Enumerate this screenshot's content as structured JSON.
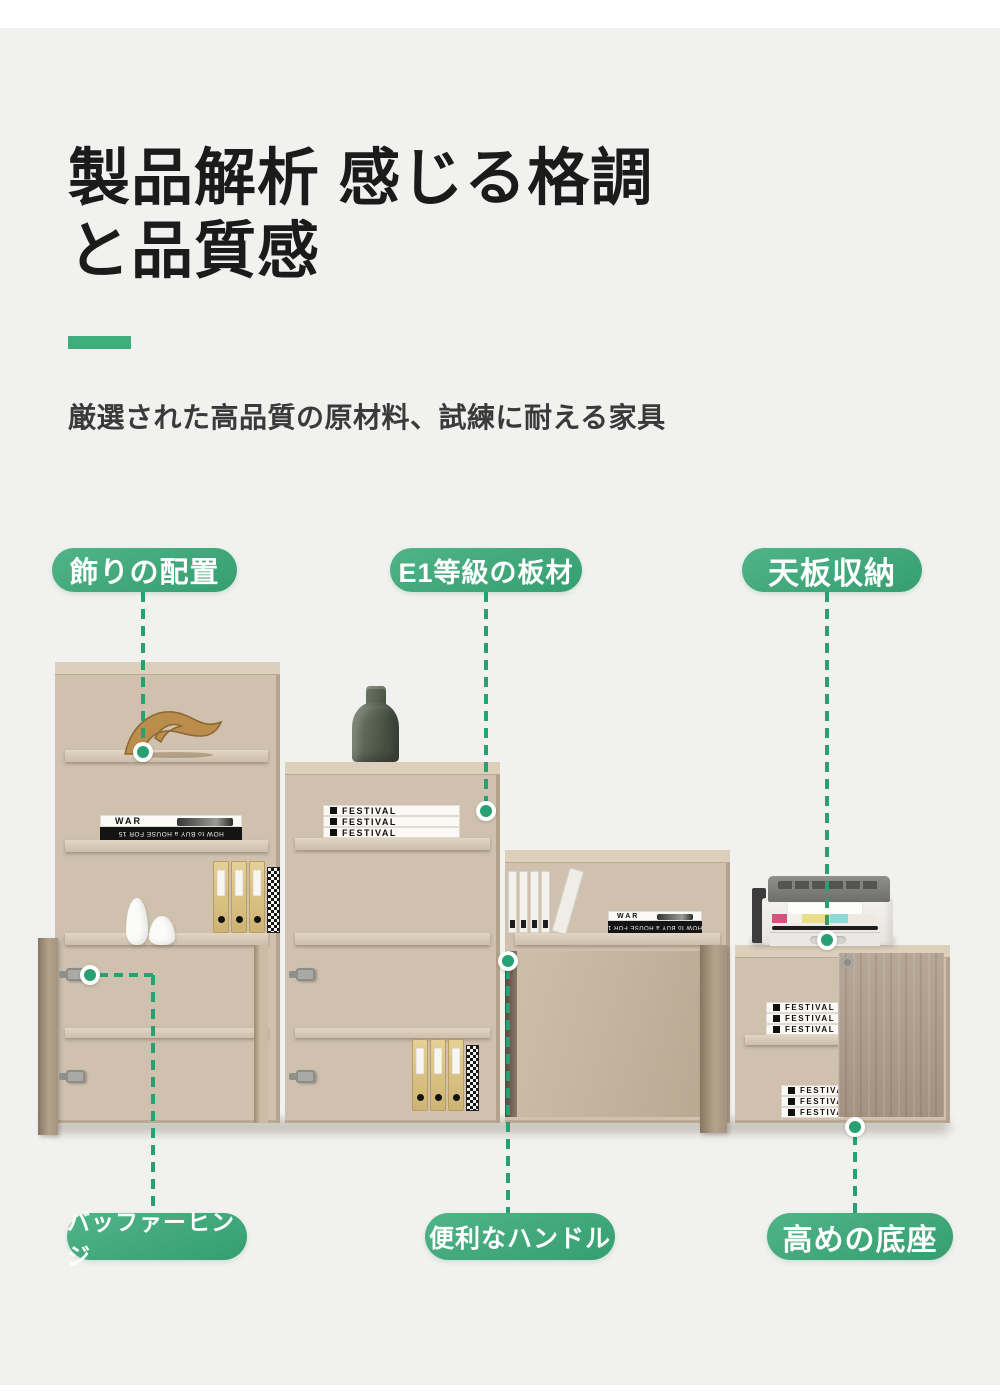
{
  "page": {
    "background": "#f1f1ef",
    "accent_green": "#3eae7d",
    "leader_green": "#27a173",
    "wood_tone": "#c6b7a3"
  },
  "header": {
    "title": "製品解析 感じる格調と品質感",
    "subtitle": "厳選された高品質の原材料、試練に耐える家具"
  },
  "callouts": {
    "top": [
      {
        "label": "飾りの配置"
      },
      {
        "label": "E1等級の板材"
      },
      {
        "label": "天板収納"
      }
    ],
    "bottom": [
      {
        "label": "バッファーヒンジ"
      },
      {
        "label": "便利なハンドル"
      },
      {
        "label": "高めの底座"
      }
    ]
  },
  "props": {
    "book_war": "WAR",
    "book_house_mirrored": "HOW to BUY a HOUSE FOR 15",
    "book_festival": "FESTIVAL"
  }
}
